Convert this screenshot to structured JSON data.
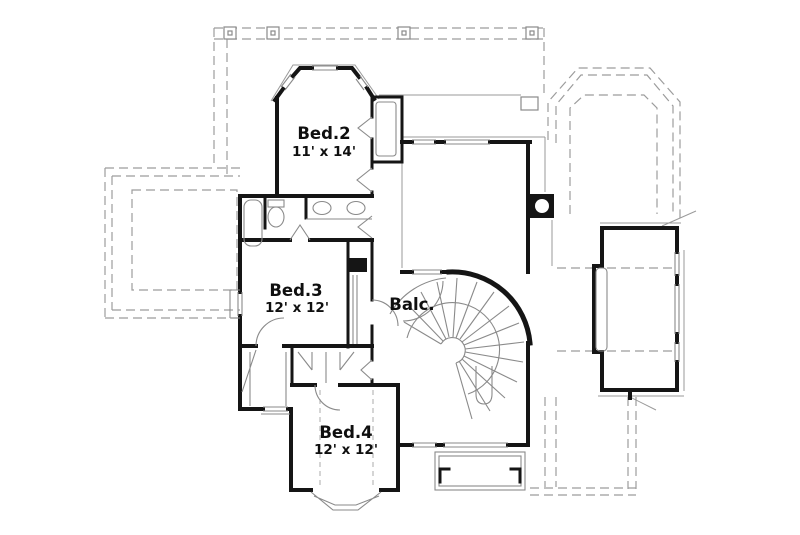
{
  "plan": {
    "rooms": {
      "bed2": {
        "label": "Bed.2",
        "size": "11' x 14'"
      },
      "bed3": {
        "label": "Bed.3",
        "size": "12' x 12'"
      },
      "bed4": {
        "label": "Bed.4",
        "size": "12' x 12'"
      },
      "balcony": {
        "label": "Balc."
      }
    },
    "colors": {
      "wall": "#151515",
      "thin_line": "#8a8a8a",
      "dashed_line": "#9c9c9c",
      "background": "#ffffff",
      "label_text": "#0f0f0f"
    }
  }
}
